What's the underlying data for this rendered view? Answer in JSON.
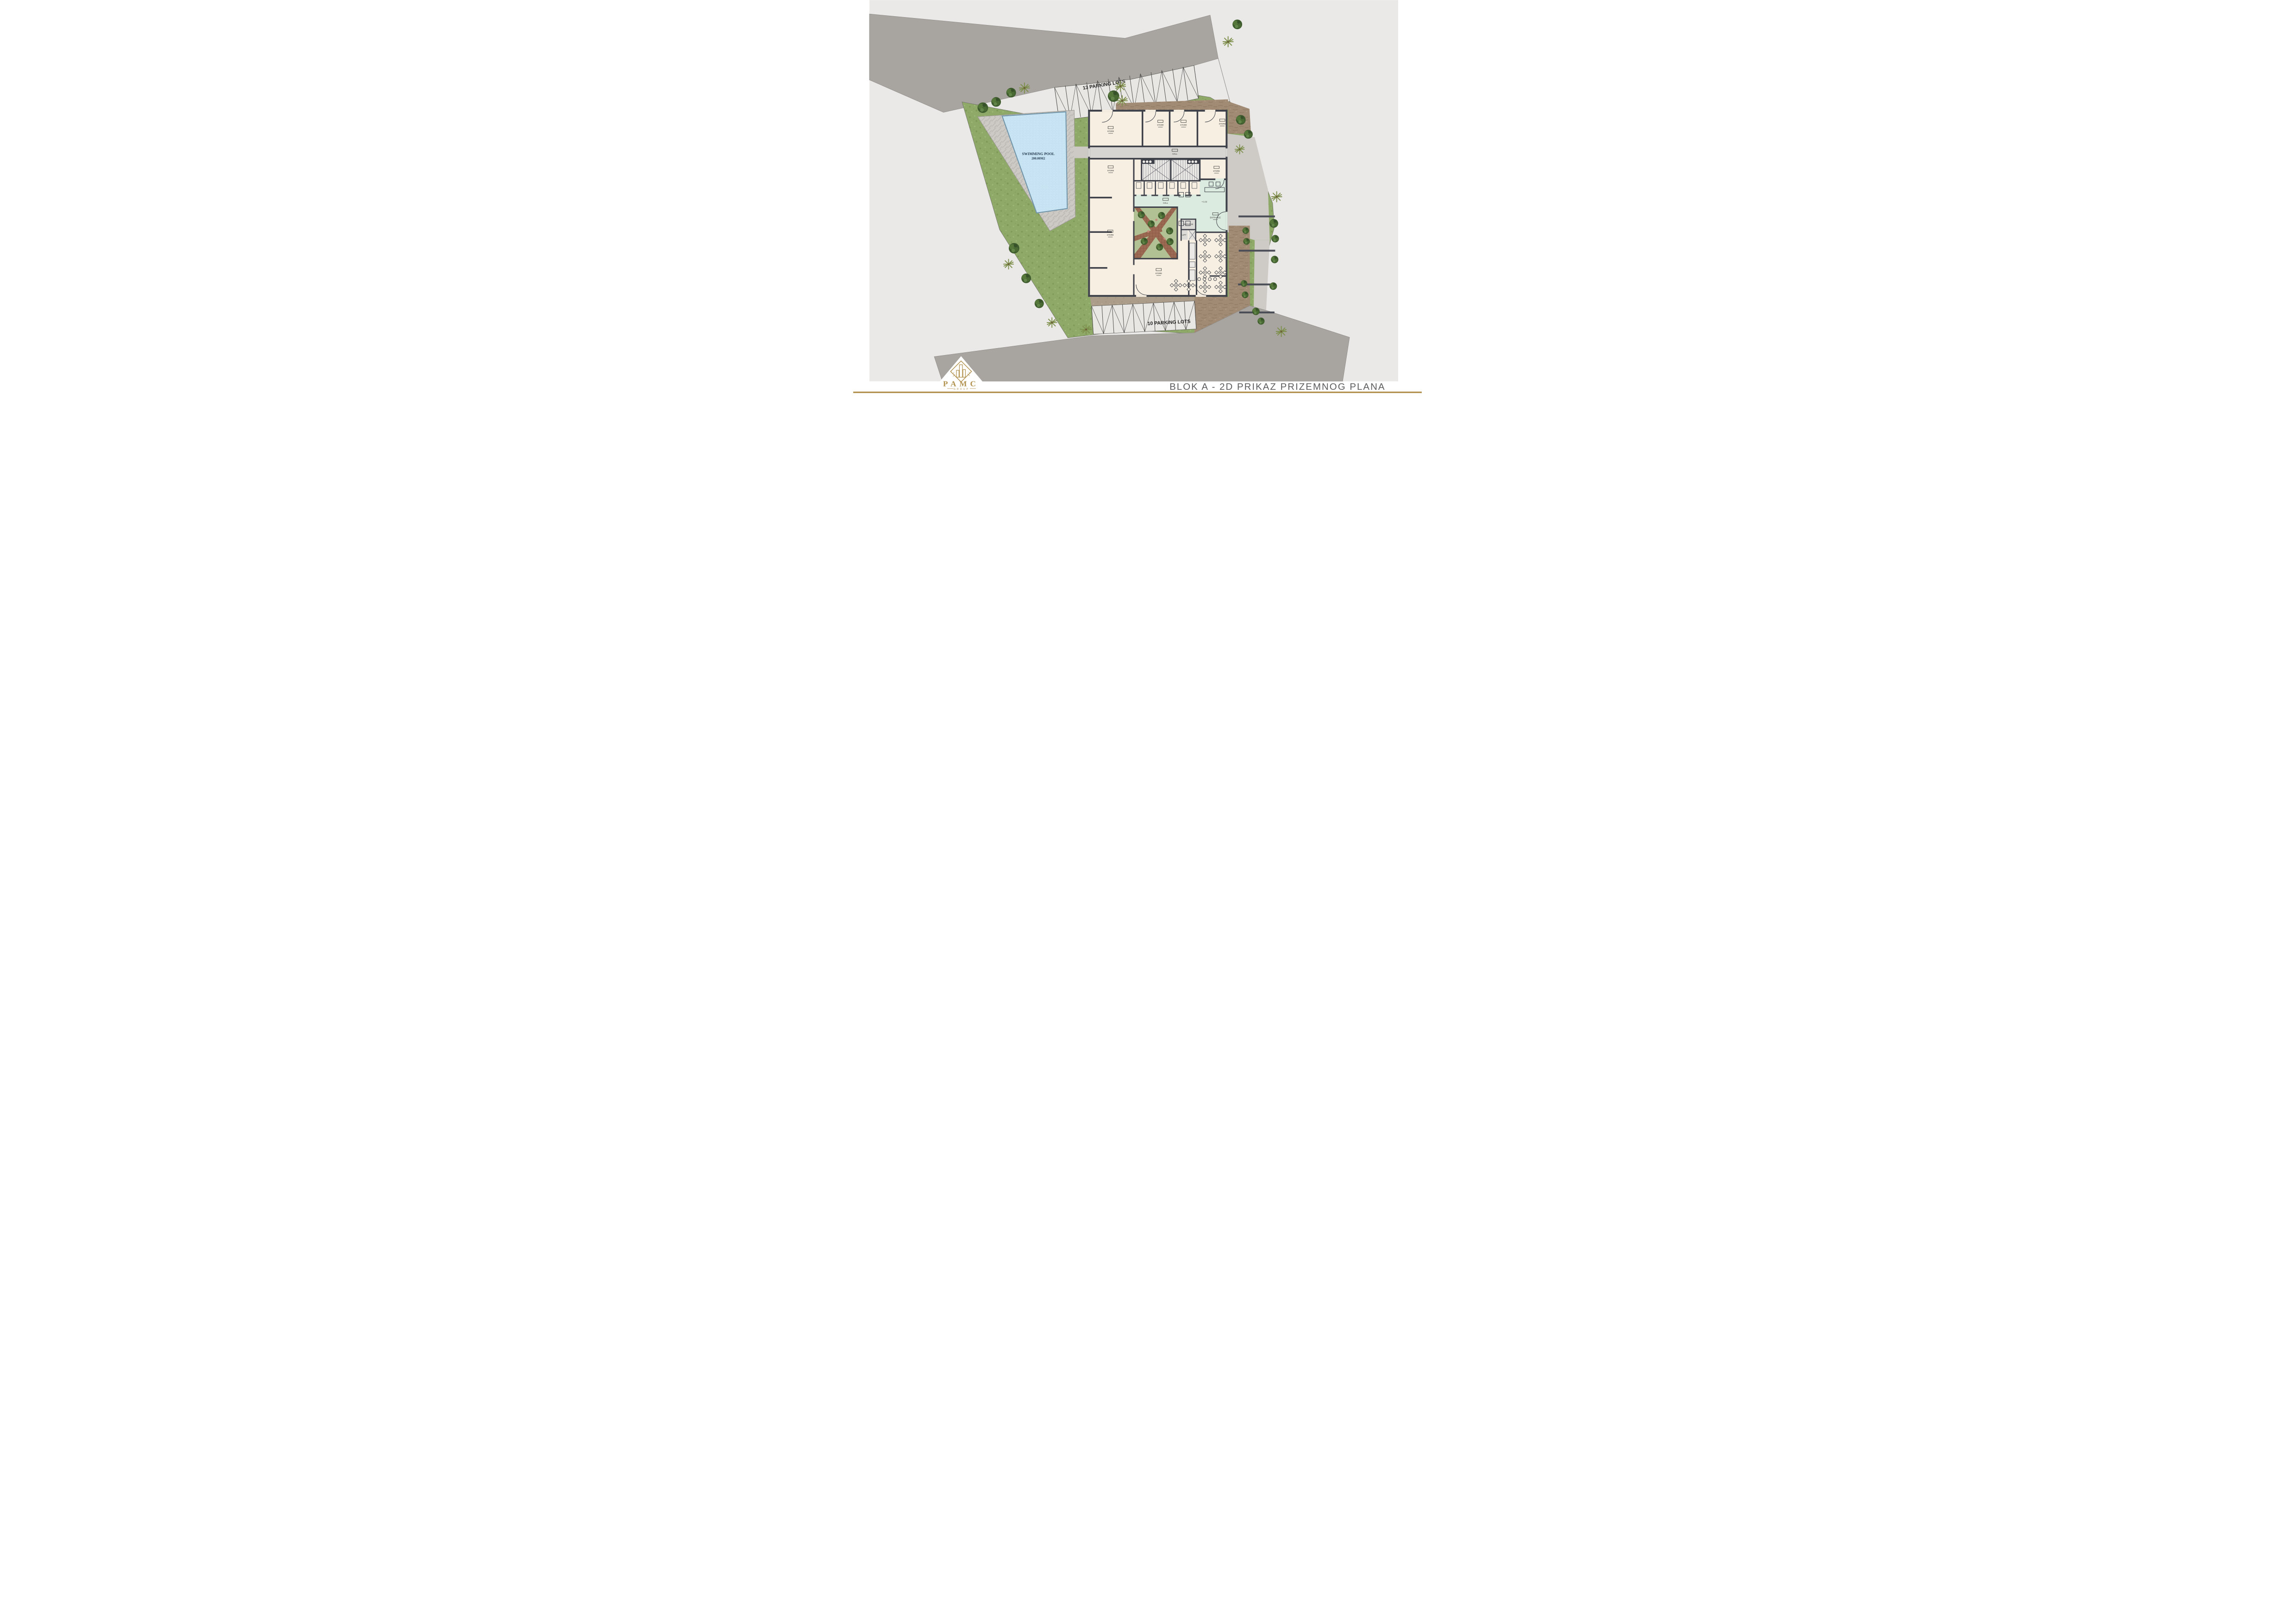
{
  "footer": {
    "title": "BLOK A - 2D PRIKAZ PRIZEMNOG PLANA",
    "logo_name": "PAMC",
    "logo_subtitle": "GROUP"
  },
  "site": {
    "parking_top_label": "13 PARKING LOTS",
    "parking_bottom_label": "10 PARKING LOTS",
    "pool_label": "SWIMMING POOL",
    "pool_area": "200.00M2"
  },
  "building_labels": {
    "store": "STORE",
    "hall": "HALL",
    "service": "SERVICE",
    "lift": "LIFT",
    "entrance": "ENTRANCE",
    "level_mark": "+0.00"
  },
  "colors": {
    "page": "#eae9e7",
    "road": "#a8a5a1",
    "grass": "#8fa968",
    "pool": "#c9e5f4",
    "wall": "#3e4149",
    "room": "#f6efe2",
    "mint_lobby": "#dcebdf",
    "courtyard_path": "#9c6a52",
    "terrace_brown": "#a18b74",
    "gold_accent": "#b2924e",
    "title_gray": "#5c5c5e"
  }
}
